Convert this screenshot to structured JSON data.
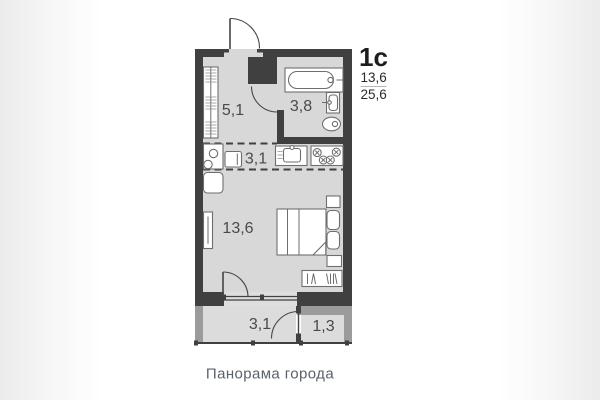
{
  "plan_card": {
    "title": "1с",
    "areas": {
      "living": "13,6",
      "total": "25,6"
    },
    "caption": "Панорама города",
    "rooms": [
      {
        "name": "hallway",
        "area": "5,1"
      },
      {
        "name": "bathroom",
        "area": "3,8"
      },
      {
        "name": "kitchen-zone",
        "area": "3,1"
      },
      {
        "name": "living-room",
        "area": "13,6"
      },
      {
        "name": "balcony",
        "area": "3,1"
      },
      {
        "name": "balcony-side",
        "area": "1,3"
      }
    ],
    "colors": {
      "wall": "#404040",
      "balcony_wall": "#9b9b9b",
      "floor": "#d8d8d8",
      "balcony_floor": "#dcdcdc",
      "window_floor": "#dedede",
      "fixture_stroke": "#6e6e6e",
      "door": "#454545",
      "label": "#4a4a4a",
      "title": "#1d1d1d",
      "area_text": "#2b2b2b",
      "divider": "#b5b5b5",
      "caption": "#5a626c"
    }
  }
}
